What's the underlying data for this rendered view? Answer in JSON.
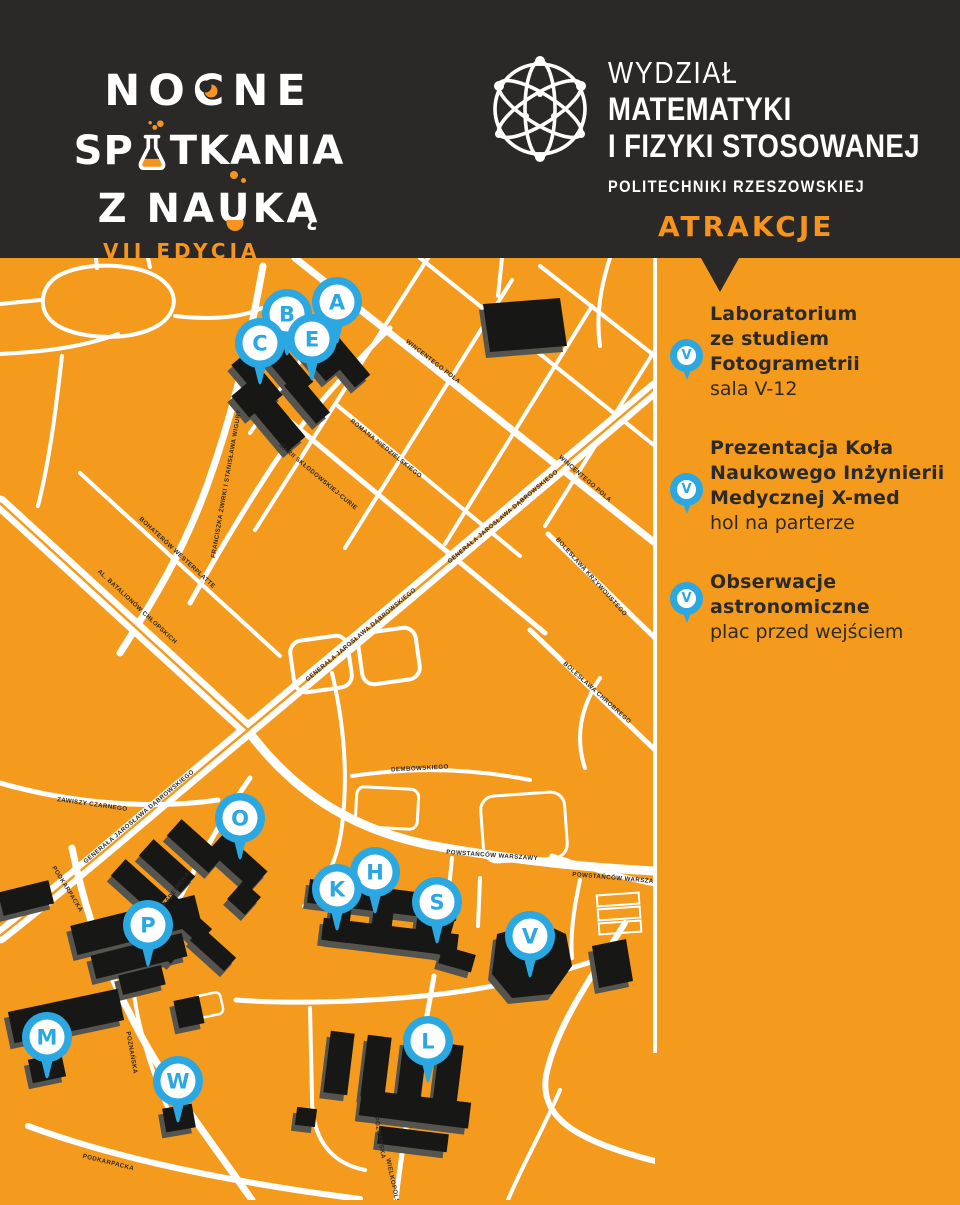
{
  "header": {
    "logo": {
      "line1_pre": "NO",
      "line1_c": "C",
      "line1_post": "NE",
      "line2_pre": "SP",
      "line2_post": "TKANIA",
      "line3_pre": "Z NA",
      "line3_u": "U",
      "line3_post": "KĄ",
      "edition": "VII EDYCJA"
    },
    "faculty": {
      "line1": "WYDZIAŁ",
      "line2": "MATEMATYKI",
      "line3": "I FIZYKI STOSOWANEJ",
      "line4": "POLITECHNIKI RZESZOWSKIEJ"
    },
    "section_title": "ATRAKCJE"
  },
  "sidebar": {
    "items": [
      {
        "pin": "V",
        "title_lines": [
          "Laboratorium",
          "ze studiem",
          "Fotogrametrii"
        ],
        "location": "sala V-12"
      },
      {
        "pin": "V",
        "title_lines": [
          "Prezentacja Koła",
          "Naukowego Inżynierii",
          "Medycznej X-med"
        ],
        "location": "hol na parterze"
      },
      {
        "pin": "V",
        "title_lines": [
          "Obserwacje",
          "astronomiczne"
        ],
        "location": "plac przed wejściem"
      }
    ]
  },
  "map": {
    "pins": [
      {
        "letter": "A",
        "x": 337,
        "y": 44
      },
      {
        "letter": "B",
        "x": 287,
        "y": 56
      },
      {
        "letter": "E",
        "x": 312,
        "y": 81
      },
      {
        "letter": "C",
        "x": 260,
        "y": 85
      },
      {
        "letter": "O",
        "x": 240,
        "y": 560
      },
      {
        "letter": "H",
        "x": 375,
        "y": 614
      },
      {
        "letter": "K",
        "x": 337,
        "y": 631
      },
      {
        "letter": "S",
        "x": 437,
        "y": 644
      },
      {
        "letter": "P",
        "x": 148,
        "y": 667
      },
      {
        "letter": "V",
        "x": 530,
        "y": 678
      },
      {
        "letter": "M",
        "x": 47,
        "y": 779
      },
      {
        "letter": "W",
        "x": 178,
        "y": 823
      },
      {
        "letter": "L",
        "x": 428,
        "y": 783
      }
    ],
    "street_labels": [
      {
        "t": "WINCENTEGO POLA",
        "x": 432,
        "y": 105,
        "r": 38
      },
      {
        "t": "WINCENTEGO POLA",
        "x": 584,
        "y": 222,
        "r": 41
      },
      {
        "t": "FRANCISZKA ŻWIRKI I STANISŁAWA WIGURY",
        "x": 228,
        "y": 226,
        "r": -80,
        "s": 5.2
      },
      {
        "t": "MARII SKŁODOWSKIEJ-CURIE",
        "x": 317,
        "y": 220,
        "r": 40,
        "s": 5.6
      },
      {
        "t": "ROMANA NIEDZIELSKIEGO",
        "x": 385,
        "y": 192,
        "r": 39,
        "s": 5.6
      },
      {
        "t": "GENERAŁA JAROSŁAWA DĄBROWSKIEGO",
        "x": 504,
        "y": 260,
        "r": -40,
        "s": 5.6
      },
      {
        "t": "GENERAŁA JAROSŁAWA DĄBROWSKIEGO",
        "x": 362,
        "y": 378,
        "r": -40,
        "s": 5.6
      },
      {
        "t": "GENERAŁA JAROSŁAWA DĄBROWSKIEGO",
        "x": 140,
        "y": 560,
        "r": -40,
        "s": 5.6
      },
      {
        "t": "AL. BATALIONÓW CHŁOPSKICH",
        "x": 136,
        "y": 350,
        "r": 43,
        "s": 5.8
      },
      {
        "t": "BOHATERÓW WESTERPLATTE",
        "x": 176,
        "y": 296,
        "r": 43,
        "s": 5.4
      },
      {
        "t": "BOLESŁAWA KRZYWOUSTEGO",
        "x": 590,
        "y": 320,
        "r": 48,
        "s": 5.4
      },
      {
        "t": "BOLESŁAWA CHROBREGO",
        "x": 596,
        "y": 436,
        "r": 42,
        "s": 5.6
      },
      {
        "t": "ZAWISZY CZARNEGO",
        "x": 92,
        "y": 548,
        "r": 8,
        "s": 5.6
      },
      {
        "t": "DEMBOWSKIEGO",
        "x": 420,
        "y": 512,
        "r": -3,
        "s": 5.6
      },
      {
        "t": "POWSTAŃCÓW WARSZAWY",
        "x": 492,
        "y": 599,
        "r": 4,
        "s": 5.6
      },
      {
        "t": "POWSTAŃCÓW WARSZAWY",
        "x": 618,
        "y": 622,
        "r": 5,
        "s": 5.6
      },
      {
        "t": "PODKARPACKA",
        "x": 66,
        "y": 632,
        "r": 58,
        "s": 5.6
      },
      {
        "t": "PODKARPACKA",
        "x": 108,
        "y": 906,
        "r": 14,
        "s": 5.6
      },
      {
        "t": "AKADEMICKA",
        "x": 176,
        "y": 634,
        "r": -54,
        "s": 5.6
      },
      {
        "t": "POZNAŃSKA",
        "x": 130,
        "y": 795,
        "r": 80,
        "s": 5.4
      },
      {
        "t": "POZNAŃSKA",
        "x": 378,
        "y": 880,
        "r": 80,
        "s": 5.4
      },
      {
        "t": "WIELKOPOLSKA",
        "x": 392,
        "y": 928,
        "r": 78,
        "s": 5.4
      }
    ]
  },
  "colors": {
    "orange": "#f49b1e",
    "dark_header": "#2a2927",
    "pin_blue": "#2ba7e1",
    "building_black": "#171716",
    "building_shadow": "#55544f",
    "accent_orange": "#f7941e"
  }
}
